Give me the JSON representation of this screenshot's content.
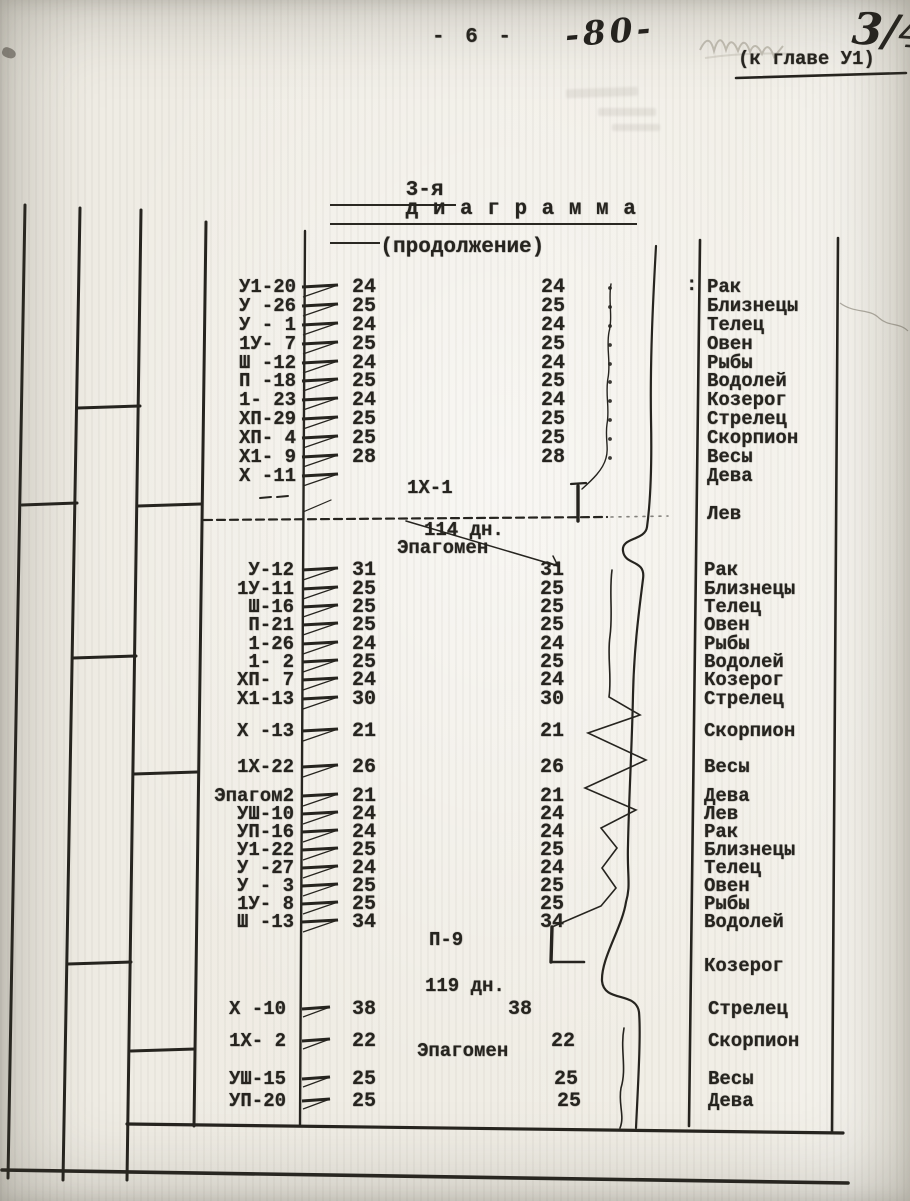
{
  "page": {
    "typed_page_number": "- 6 -",
    "handwritten_page_number": "-80-",
    "handwritten_corner_mark": "3/4",
    "chapter_reference": "(к главе У1)",
    "title": {
      "prefix": "3-я",
      "word": "д и а г р а м м а",
      "suffix": "(продолжение)"
    }
  },
  "diagram": {
    "ink_color": "#26241f",
    "paper_color": "#edeae2",
    "colon_mark": ":",
    "separator_1": {
      "label": "1Х-1",
      "days": "114 дн.",
      "note": "Эпагомен"
    },
    "separator_2": {
      "label": "П-9",
      "days": "119 дн.",
      "note": "Эпагомен"
    },
    "blocks": [
      {
        "rows": [
          {
            "date": "У1-20",
            "n1": "24",
            "n2": "24",
            "sign": "Рак"
          },
          {
            "date": "У -26",
            "n1": "25",
            "n2": "25",
            "sign": "Близнецы"
          },
          {
            "date": "У - 1",
            "n1": "24",
            "n2": "24",
            "sign": "Телец"
          },
          {
            "date": "1У- 7",
            "n1": "25",
            "n2": "25",
            "sign": "Овен"
          },
          {
            "date": "Ш -12",
            "n1": "24",
            "n2": "24",
            "sign": "Рыбы"
          },
          {
            "date": "П -18",
            "n1": "25",
            "n2": "25",
            "sign": "Водолей"
          },
          {
            "date": "1- 23",
            "n1": "24",
            "n2": "24",
            "sign": "Козерог"
          },
          {
            "date": "ХП-29",
            "n1": "25",
            "n2": "25",
            "sign": "Стрелец"
          },
          {
            "date": "ХП- 4",
            "n1": "25",
            "n2": "25",
            "sign": "Скорпион"
          },
          {
            "date": "Х1- 9",
            "n1": "28",
            "n2": "28",
            "sign": "Весы"
          },
          {
            "date": "Х -11",
            "n1": "",
            "n2": "",
            "sign": "Дева"
          },
          {
            "date": "",
            "n1": "",
            "n2": "",
            "sign": "Лев"
          }
        ]
      },
      {
        "rows": [
          {
            "date": "У-12",
            "n1": "31",
            "n2": "31",
            "sign": "Рак"
          },
          {
            "date": "1У-11",
            "n1": "25",
            "n2": "25",
            "sign": "Близнецы"
          },
          {
            "date": "Ш-16",
            "n1": "25",
            "n2": "25",
            "sign": "Телец"
          },
          {
            "date": "П-21",
            "n1": "25",
            "n2": "25",
            "sign": "Овен"
          },
          {
            "date": "1-26",
            "n1": "24",
            "n2": "24",
            "sign": "Рыбы"
          },
          {
            "date": "1- 2",
            "n1": "25",
            "n2": "25",
            "sign": "Водолей"
          },
          {
            "date": "ХП- 7",
            "n1": "24",
            "n2": "24",
            "sign": "Козерог"
          },
          {
            "date": "Х1-13",
            "n1": "30",
            "n2": "30",
            "sign": "Стрелец"
          },
          {
            "date": "Х -13",
            "n1": "21",
            "n2": "21",
            "sign": "Скорпион"
          },
          {
            "date": "1Х-22",
            "n1": "26",
            "n2": "26",
            "sign": "Весы"
          },
          {
            "date": "Эпагом2",
            "n1": "21",
            "n2": "21",
            "sign": "Дева"
          },
          {
            "date": "УШ-10",
            "n1": "24",
            "n2": "24",
            "sign": "Лев"
          },
          {
            "date": "УП-16",
            "n1": "24",
            "n2": "24",
            "sign": "Рак"
          },
          {
            "date": "У1-22",
            "n1": "25",
            "n2": "25",
            "sign": "Близнецы"
          },
          {
            "date": "У -27",
            "n1": "24",
            "n2": "24",
            "sign": "Телец"
          },
          {
            "date": "У - 3",
            "n1": "25",
            "n2": "25",
            "sign": "Овен"
          },
          {
            "date": "1У- 8",
            "n1": "25",
            "n2": "25",
            "sign": "Рыбы"
          },
          {
            "date": "Ш -13",
            "n1": "34",
            "n2": "34",
            "sign": "Водолей"
          },
          {
            "date": "",
            "n1": "",
            "n2": "",
            "sign": "Козерог"
          }
        ]
      },
      {
        "rows": [
          {
            "date": "Х -10",
            "n1": "38",
            "n2": "38",
            "sign": "Стрелец"
          },
          {
            "date": "1Х- 2",
            "n1": "22",
            "n2": "22",
            "sign": "Скорпион"
          },
          {
            "date": "УШ-15",
            "n1": "25",
            "n2": "25",
            "sign": "Весы"
          },
          {
            "date": "УП-20",
            "n1": "25",
            "n2": "25",
            "sign": "Дева"
          }
        ]
      }
    ]
  }
}
